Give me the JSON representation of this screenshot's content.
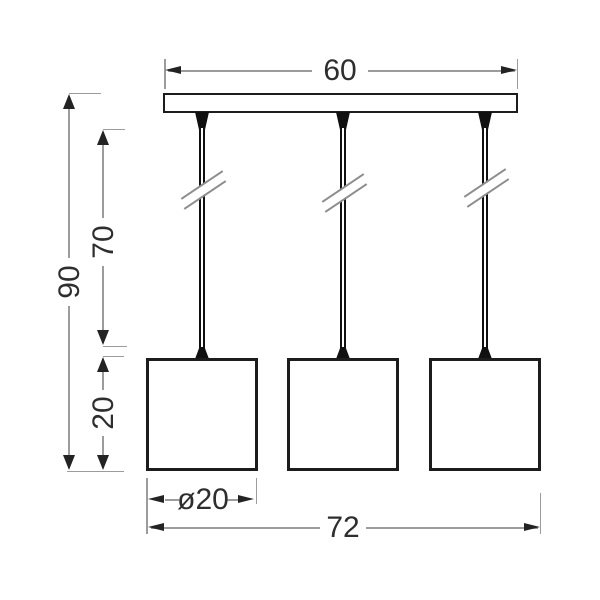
{
  "drawing": {
    "kind": "technical dimension drawing, front elevation",
    "subject": "three-shade pendant lamp",
    "shade_count": 3,
    "cable_count": 3,
    "colors": {
      "background": "#ffffff",
      "fixture_outline": "#1c1c1c",
      "dimension_line": "#9c9c9c",
      "arrow": "#232323",
      "label_text": "#2e2e2e",
      "break_mark": "#8d8d8d"
    }
  },
  "dimensions": {
    "bar_width": "60",
    "overall_height": "90",
    "cable_drop": "70",
    "shade_height": "20",
    "shade_diameter": "ø20",
    "overall_width": "72"
  }
}
